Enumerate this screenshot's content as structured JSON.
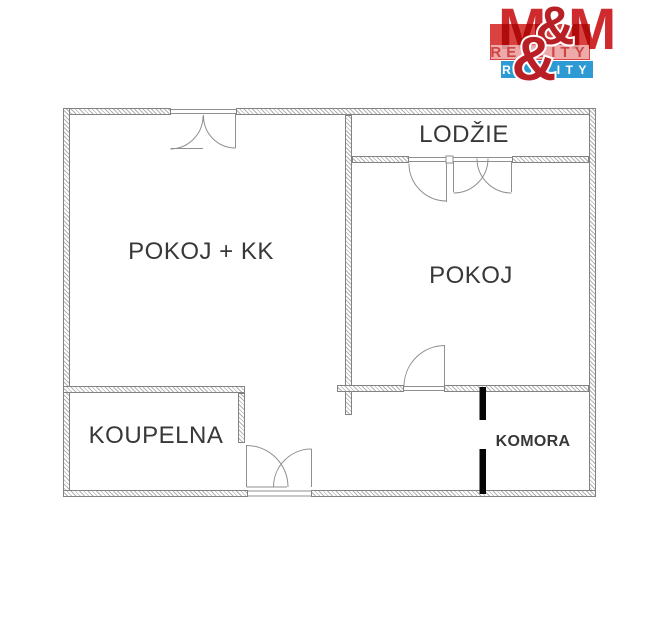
{
  "logo": {
    "letter_m": "M",
    "ampersand": "&",
    "reality": "REALITY",
    "watermark_reality": "REALITY",
    "colors": {
      "red": "#cf2b2f",
      "dark_red": "#b92026",
      "box_red": "#da4241",
      "blue": "#2e9ad3",
      "pale_strip": "#e9d0cc"
    }
  },
  "floor_plan": {
    "rooms": [
      {
        "id": "pokoj-kk",
        "label": "POKOJ + KK"
      },
      {
        "id": "pokoj",
        "label": "POKOJ"
      },
      {
        "id": "lodzie",
        "label": "LODŽIE"
      },
      {
        "id": "koupelna",
        "label": "KOUPELNA"
      },
      {
        "id": "komora",
        "label": "KOMORA"
      }
    ],
    "wall_color": "#828282",
    "partition_color": "#050505"
  }
}
